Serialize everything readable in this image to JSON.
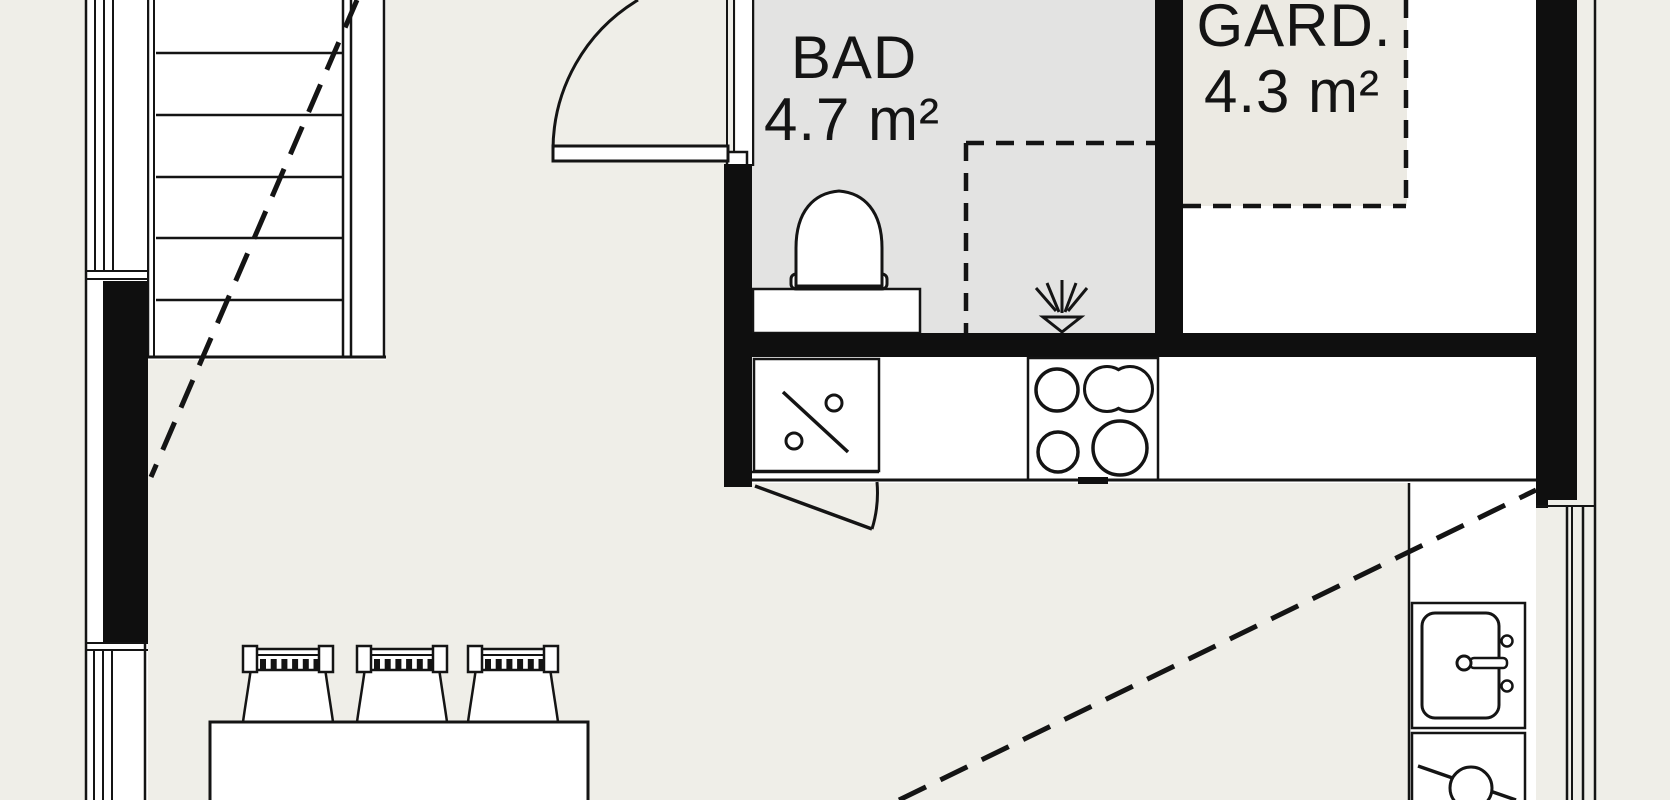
{
  "rooms": {
    "bad": {
      "name": "BAD",
      "area": "4.7 m²"
    },
    "gard": {
      "name": "GARD.",
      "area": "4.3 m²"
    }
  },
  "colors": {
    "background": "#efeee8",
    "bad_floor": "#e3e3e2",
    "wardrobe_area": "#eceae3",
    "gard_floor": "#ffffff",
    "wall": "#0f0f0f",
    "line": "#141414"
  },
  "symbols": {
    "staircase": "parallel treads with diagonal break line",
    "doors": "quarter-circle swing arcs",
    "shower": "dashed square with spray head",
    "wardrobe": "dashed rectangle",
    "stove": "four burner circles",
    "sinks": "basin with faucet / square with diagonal and two knobs"
  }
}
